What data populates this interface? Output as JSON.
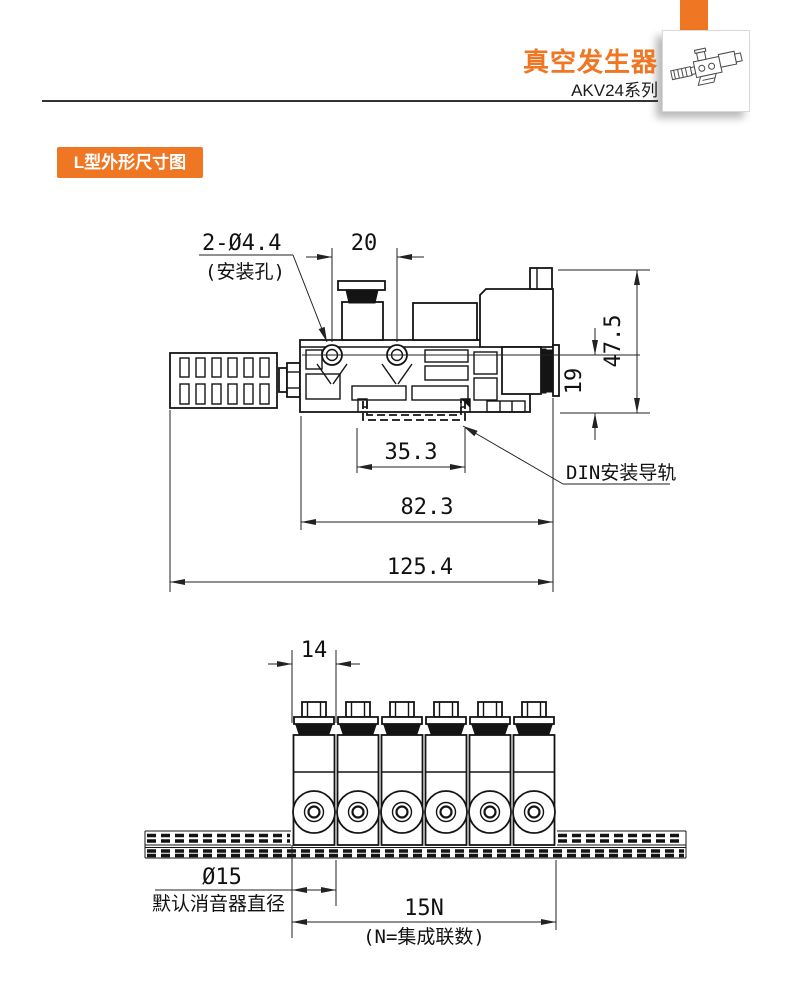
{
  "colors": {
    "accent": "#EF7622"
  },
  "header": {
    "title": "真空发生器",
    "series": "AKV24系列"
  },
  "section": {
    "label": "L型外形尺寸图"
  },
  "side_view": {
    "dim_mount_holes": "2-Ø4.4",
    "dim_mount_holes_note": "(安装孔)",
    "dim_hole_pitch": "20",
    "dim_total_height": "47.5",
    "dim_axis_height": "19",
    "dim_rail_width": "35.3",
    "dim_body_length": "82.3",
    "dim_total_length": "125.4",
    "rail_label": "DIN安装导轨"
  },
  "front_view": {
    "dim_unit_pitch": "14",
    "dim_silencer_dia": "Ø15",
    "dim_silencer_dia_note": "默认消音器直径",
    "dim_total_width": "15N",
    "dim_total_width_note": "(N=集成联数)"
  }
}
